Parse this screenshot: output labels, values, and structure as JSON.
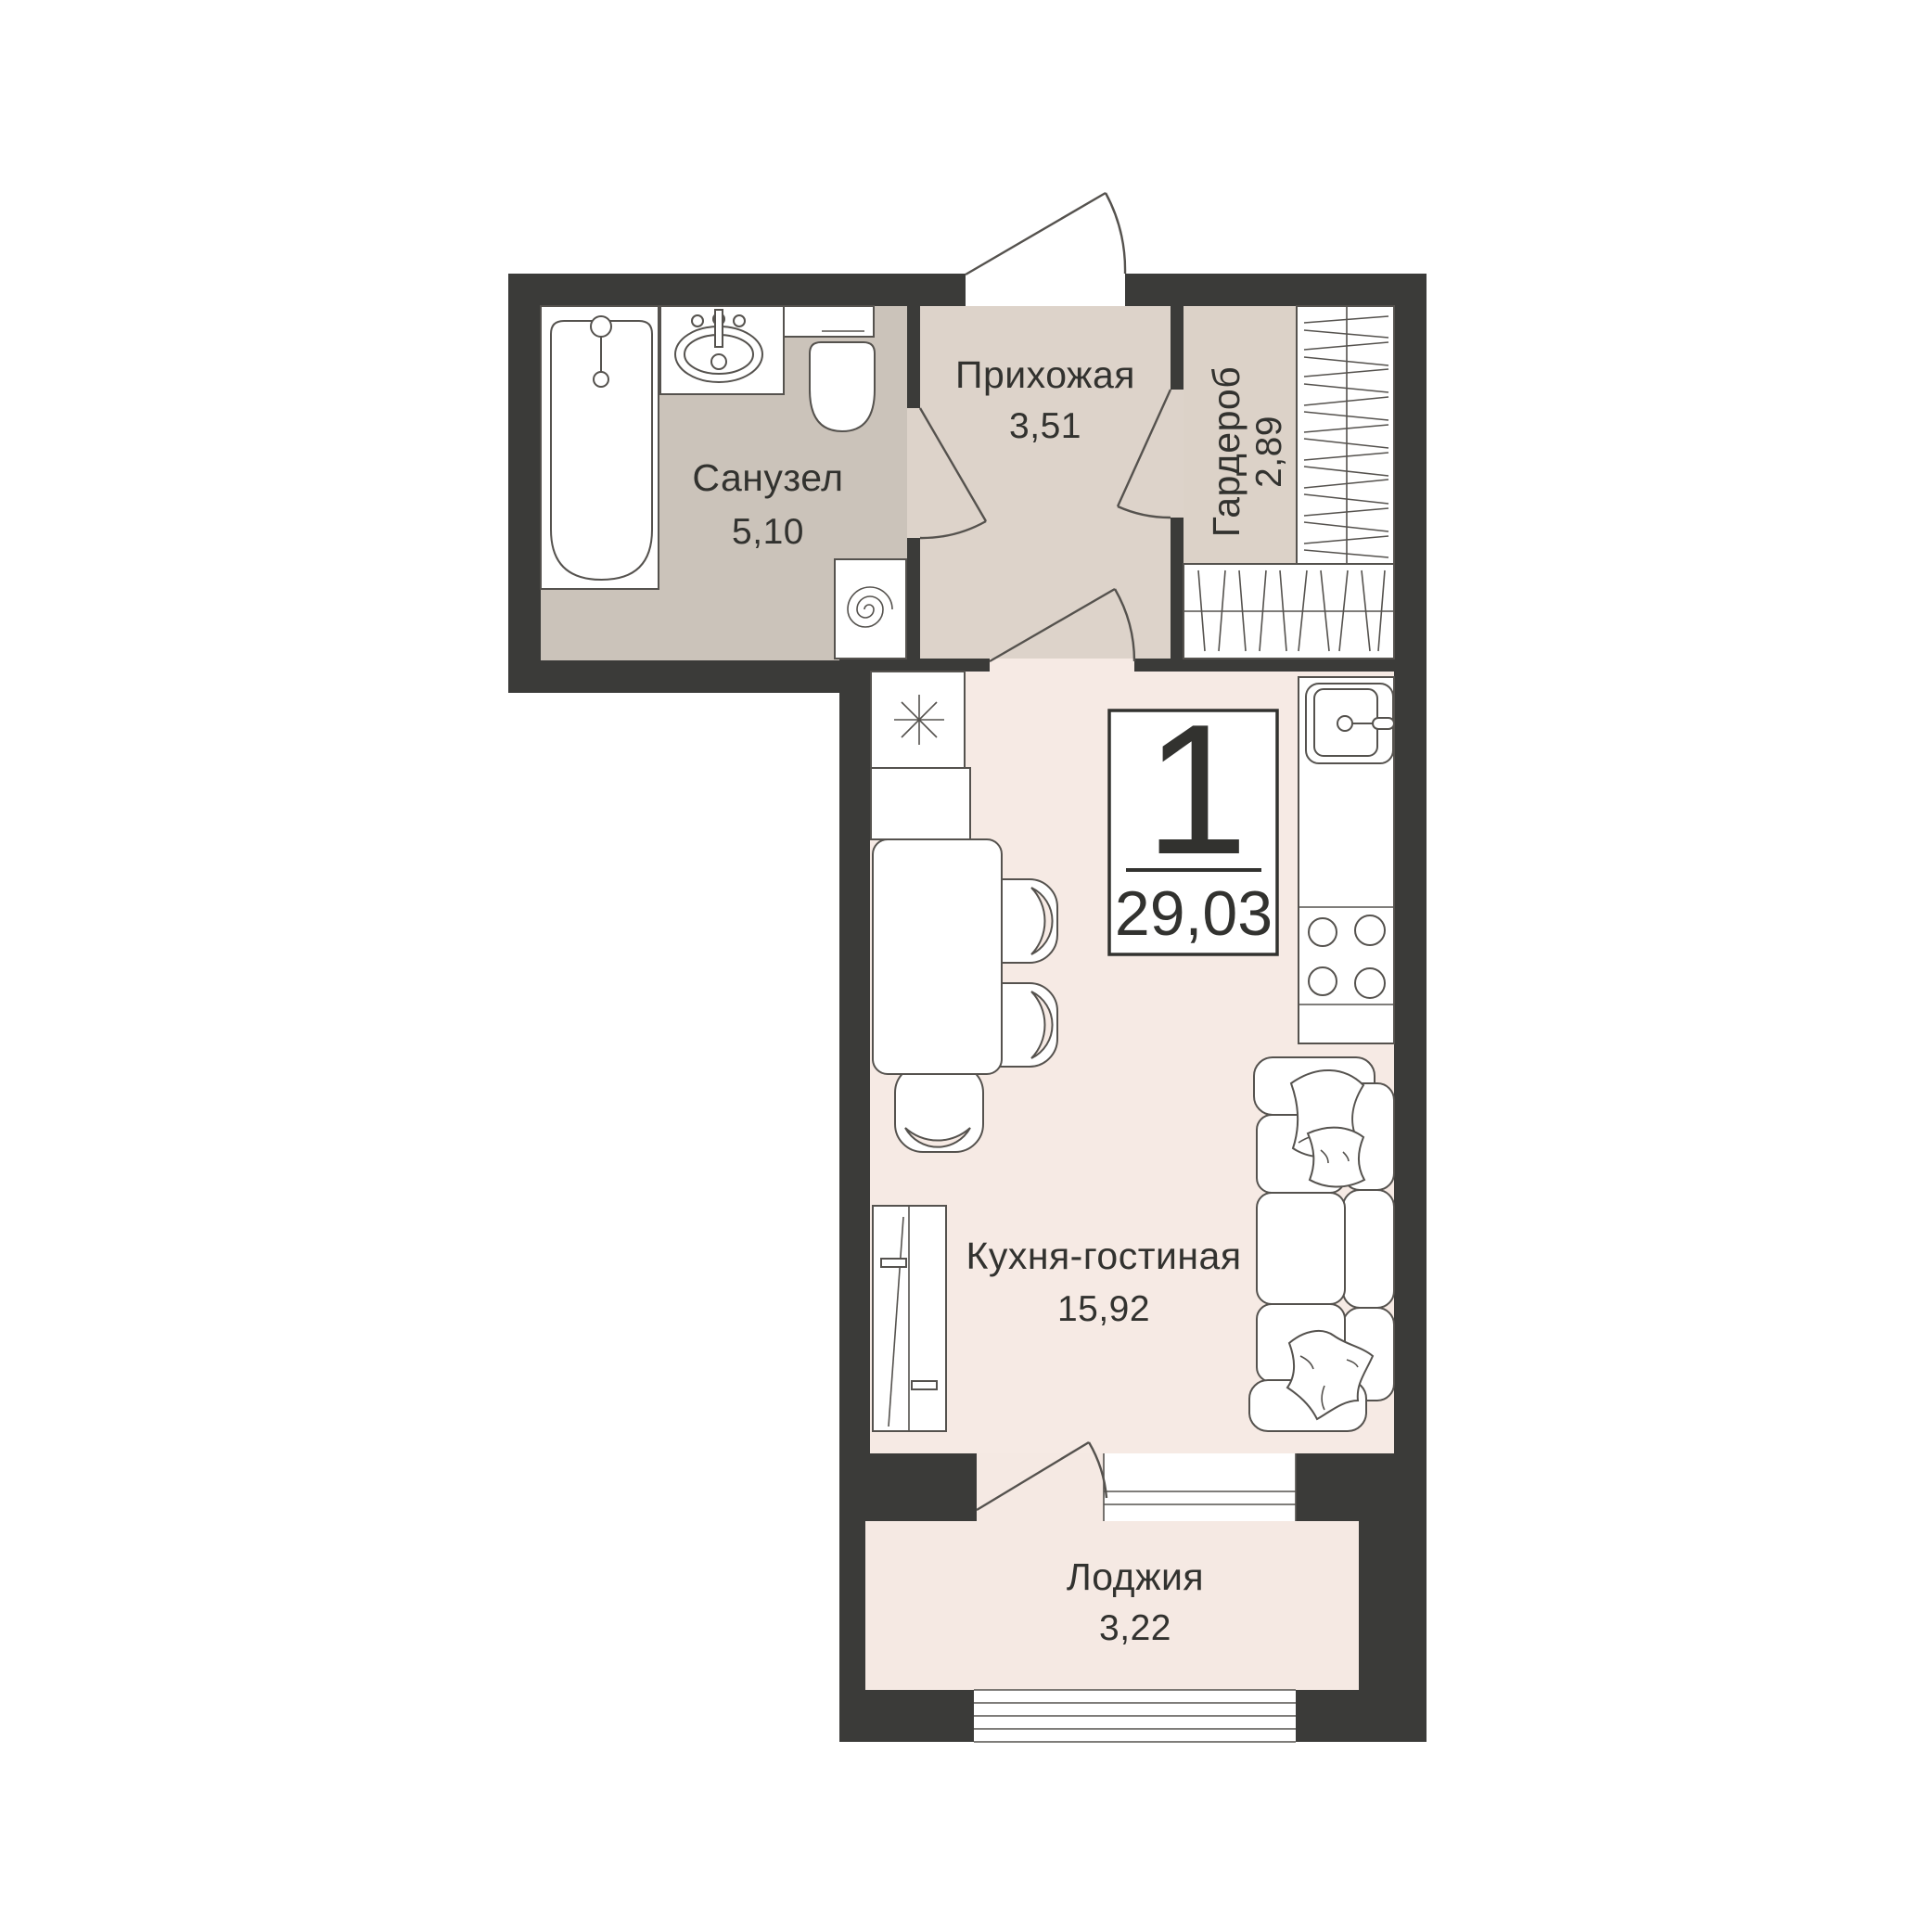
{
  "plan": {
    "type": "apartment-floor-plan",
    "rooms": {
      "bathroom": {
        "name": "Санузел",
        "area": "5,10"
      },
      "hallway": {
        "name": "Прихожая",
        "area": "3,51"
      },
      "wardrobe": {
        "name": "Гардероб",
        "area": "2,89"
      },
      "kitchen_living": {
        "name": "Кухня-гостиная",
        "area": "15,92"
      },
      "loggia": {
        "name": "Лоджия",
        "area": "3,22"
      }
    },
    "info_box": {
      "room_count": "1",
      "total_area": "29,03"
    },
    "fixtures": [
      "bathtub-icon",
      "bath-sink-icon",
      "toilet-icon",
      "washing-machine-icon",
      "fridge-snowflake-icon",
      "dining-table",
      "chairs",
      "kitchen-sink-icon",
      "stove-burners-icon",
      "tv-cabinet",
      "corner-sofa",
      "pillows",
      "wardrobe-shelving",
      "entrance-door",
      "interior-doors",
      "loggia-window",
      "loggia-glazing"
    ]
  },
  "colors": {
    "page_bg": "#ffffff",
    "wall": "#3b3b39",
    "floor_bathroom": "#cbc3ba",
    "floor_hallway": "#ddd3ca",
    "floor_wardrobe": "#dcd2c8",
    "floor_kitchen": "#f6eae4",
    "floor_loggia": "#f5e9e3",
    "line": "#55524e",
    "text": "#32322f"
  }
}
